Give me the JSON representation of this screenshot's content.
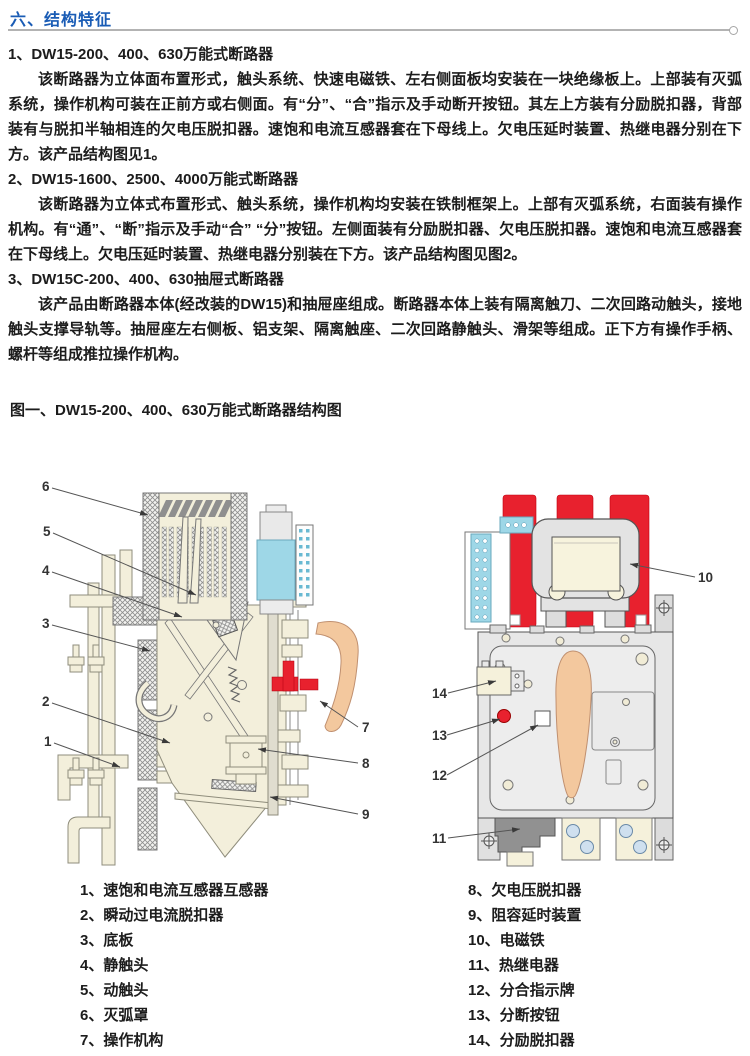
{
  "header": {
    "section_title": "六、结构特征"
  },
  "sections": [
    {
      "heading": "1、DW15-200、400、630万能式断路器",
      "body": "该断路器为立体面布置形式，触头系统、快速电磁铁、左右侧面板均安装在一块绝缘板上。上部装有灭弧系统，操作机构可装在正前方或右侧面。有“分”、“合”指示及手动断开按钮。其左上方装有分励脱扣器，背部装有与脱扣半轴相连的欠电压脱扣器。速饱和电流互感器套在下母线上。欠电压延时装置、热继电器分别在下方。该产品结构图见1。"
    },
    {
      "heading": "2、DW15-1600、2500、4000万能式断路器",
      "body": "该断路器为立体式布置形式、触头系统，操作机构均安装在铁制框架上。上部有灭弧系统，右面装有操作机构。有“通”、“断”指示及手动“合” “分”按钮。左侧面装有分励脱扣器、欠电压脱扣器。速饱和电流互感器套在下母线上。欠电压延时装置、热继电器分别装在下方。该产品结构图见图2。"
    },
    {
      "heading": "3、DW15C-200、400、630抽屉式断路器",
      "body": "该产品由断路器本体(经改装的DW15)和抽屉座组成。断路器本体上装有隔离触刀、二次回路动触头，接地触头支撑导轨等。抽屉座左右侧板、铝支架、隔离触座、二次回路静触头、滑架等组成。正下方有操作手柄、螺杆等组成推拉操作机构。"
    }
  ],
  "figure": {
    "title": "图一、DW15-200、400、630万能式断路器结构图",
    "left_callouts": [
      "1",
      "2",
      "3",
      "4",
      "5",
      "6",
      "7",
      "8",
      "9"
    ],
    "right_callouts": [
      "10",
      "11",
      "12",
      "13",
      "14"
    ],
    "legend_left": [
      "1、速饱和电流互感器互感器",
      "2、瞬动过电流脱扣器",
      "3、底板",
      "4、静触头",
      "5、动触头",
      "6、灭弧罩",
      "7、操作机构"
    ],
    "legend_right": [
      "8、欠电压脱扣器",
      "9、阻容延时装置",
      "10、电磁铁",
      "11、热继电器",
      "12、分合指示牌",
      "13、分断按钮",
      "14、分励脱扣器"
    ]
  },
  "colors": {
    "accent_blue": "#1a5cb5",
    "diagram_red": "#e8212e",
    "diagram_cyan": "#9ed7e7",
    "diagram_tan": "#f3c89e",
    "diagram_cream": "#f3efdb"
  }
}
